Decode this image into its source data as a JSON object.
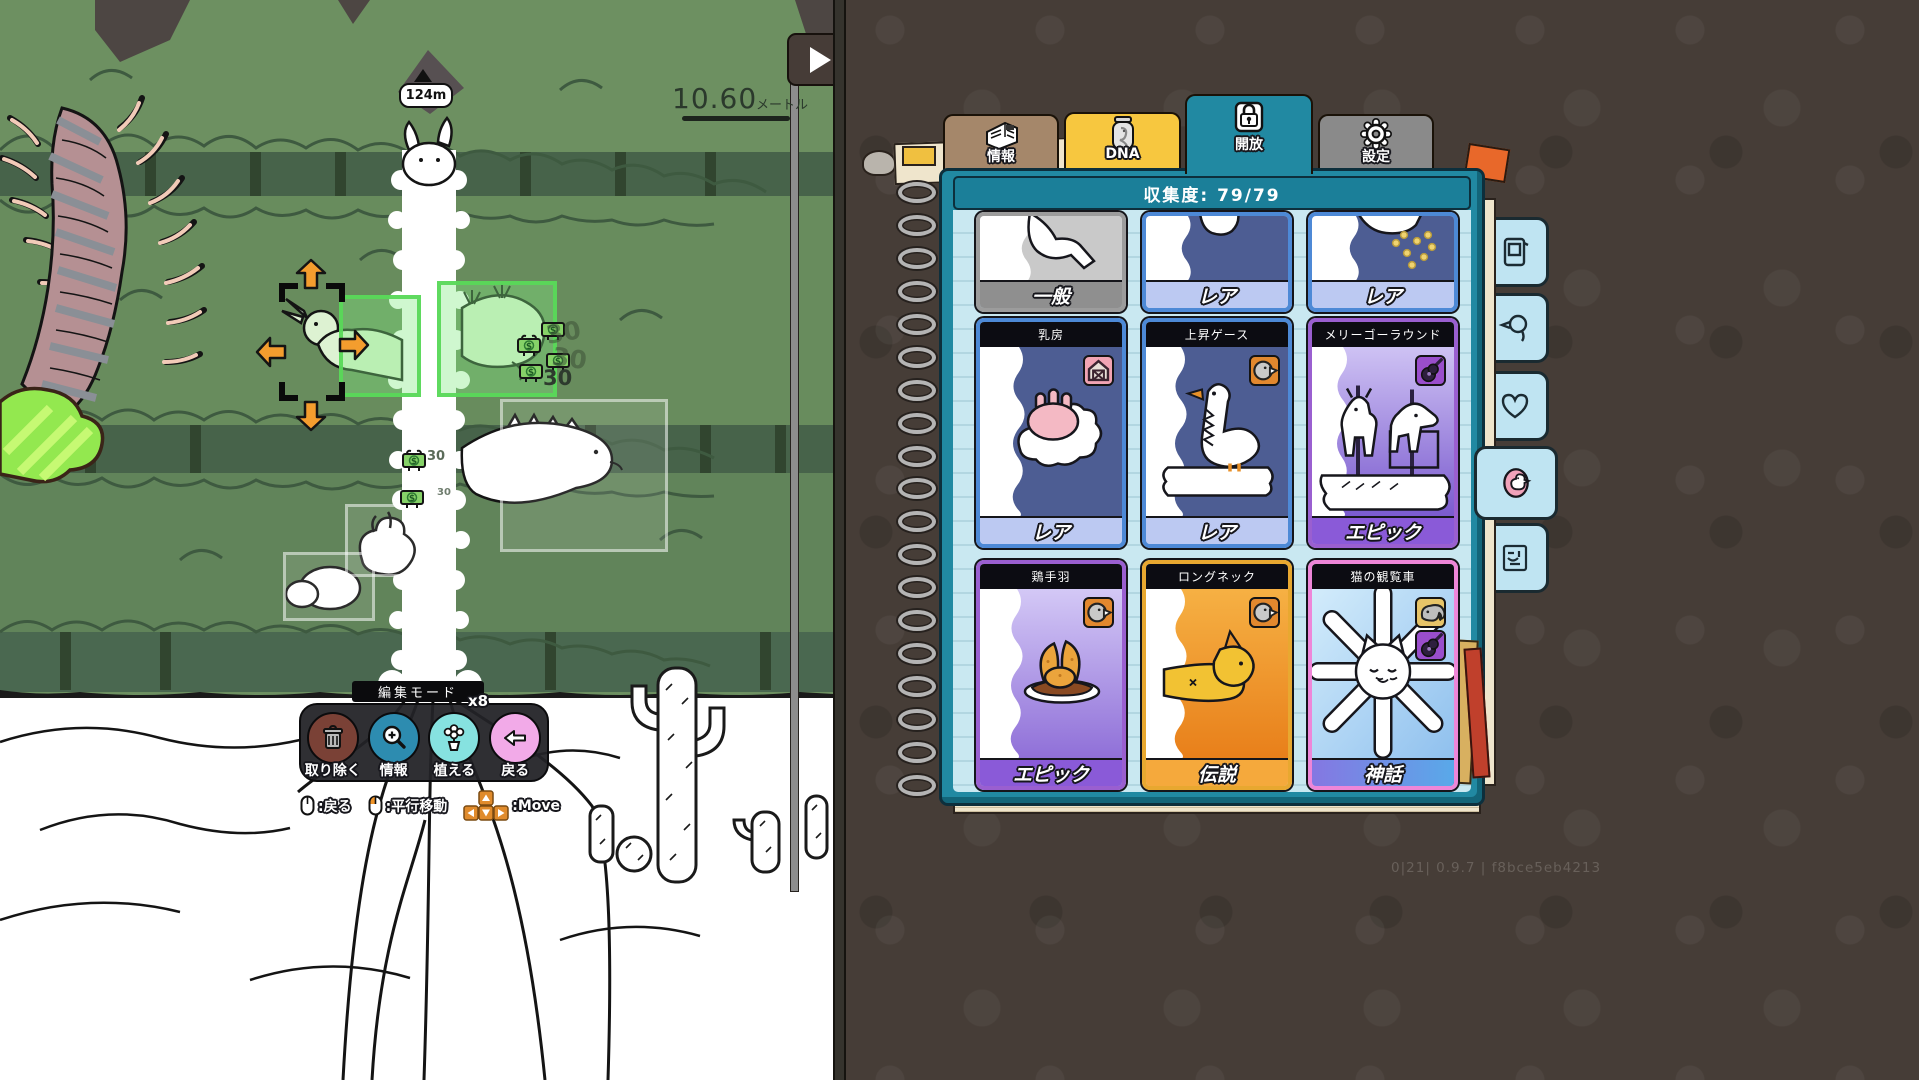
{
  "game": {
    "height_marker": "124m",
    "scale": {
      "value": "10.60",
      "unit": "メートル"
    },
    "selection": {
      "currency": "$",
      "costs": [
        "30",
        "30",
        "30",
        "30",
        "30"
      ]
    },
    "edit_mode": {
      "title": "編集モード",
      "buttons": [
        {
          "label": "取り除く",
          "icon": "trash-icon",
          "color": "#7a4136"
        },
        {
          "label": "情報",
          "icon": "magnifier-plus-icon",
          "color": "#2d8cb0"
        },
        {
          "label": "植える",
          "icon": "flower-pot-icon",
          "color": "#86e2e0",
          "count": "x8"
        },
        {
          "label": "戻る",
          "icon": "arrow-left-icon",
          "color": "#f2aae8"
        }
      ],
      "hints": [
        {
          "icon": "mouse-icon",
          "label": ":戻る"
        },
        {
          "icon": "mouse-left-click-icon",
          "label": ":平行移動"
        },
        {
          "icon": "arrow-keys-icon",
          "label": ":Move"
        }
      ]
    }
  },
  "book": {
    "tabs": [
      {
        "label": "情報",
        "icon": "newspaper-icon",
        "color": "#a5876a",
        "active": false
      },
      {
        "label": "DNA",
        "icon": "jar-icon",
        "color": "#f7c73f",
        "active": false
      },
      {
        "label": "開放",
        "icon": "lock-icon",
        "color": "#2189a2",
        "active": true
      },
      {
        "label": "設定",
        "icon": "gear-icon",
        "color": "#8a8a8a",
        "active": false
      }
    ],
    "header": "収集度: 79/79",
    "top_row_cards": [
      {
        "rarity_label": "一般",
        "rarity": "common"
      },
      {
        "rarity_label": "レア",
        "rarity": "rare"
      },
      {
        "rarity_label": "レア",
        "rarity": "rare"
      }
    ],
    "cards": [
      {
        "title": "乳房",
        "rarity_label": "レア",
        "rarity": "rare",
        "badges": [
          "barn-icon"
        ]
      },
      {
        "title": "上昇ゲース",
        "rarity_label": "レア",
        "rarity": "rare",
        "badges": [
          "goose-icon"
        ]
      },
      {
        "title": "メリーゴーラウンド",
        "rarity_label": "エピック",
        "rarity": "epic",
        "badges": [
          "guitar-icon"
        ]
      },
      {
        "title": "鶏手羽",
        "rarity_label": "エピック",
        "rarity": "epic",
        "badges": [
          "goose-icon"
        ]
      },
      {
        "title": "ロングネック",
        "rarity_label": "伝説",
        "rarity": "legend",
        "badges": [
          "goose-icon"
        ]
      },
      {
        "title": "猫の観覧車",
        "rarity_label": "神話",
        "rarity": "myth",
        "badges": [
          "elephant-icon",
          "guitar-icon"
        ]
      }
    ],
    "side_tabs": [
      {
        "icon": "card-device-icon",
        "active": false
      },
      {
        "icon": "duck-icon",
        "active": false
      },
      {
        "icon": "heart-icon",
        "active": false
      },
      {
        "icon": "egg-goose-icon",
        "active": true
      },
      {
        "icon": "stamp-icon",
        "active": false
      }
    ],
    "version": "0|21| 0.9.7 | f8bce5eb4213"
  },
  "colors": {
    "rarity": {
      "common": {
        "border": "#9c9c9c",
        "label_bg": "#8f8f8f"
      },
      "rare": {
        "border": "#4d89d6",
        "body": "#4d5d93",
        "label_bg": "#bcc9f2"
      },
      "epic": {
        "border": "#9a5fd0",
        "label_bg": "#8a5ad8"
      },
      "legend": {
        "border": "#e8a830",
        "label_bg": "#f5a93c"
      },
      "myth": {
        "border": "#ee86d8",
        "label_bg_gradient": [
          "#8577e2",
          "#59a9e9"
        ]
      }
    },
    "selection_green": "#58d858",
    "arrow_orange": "#f49d2e",
    "book_teal": "#2189a2"
  }
}
